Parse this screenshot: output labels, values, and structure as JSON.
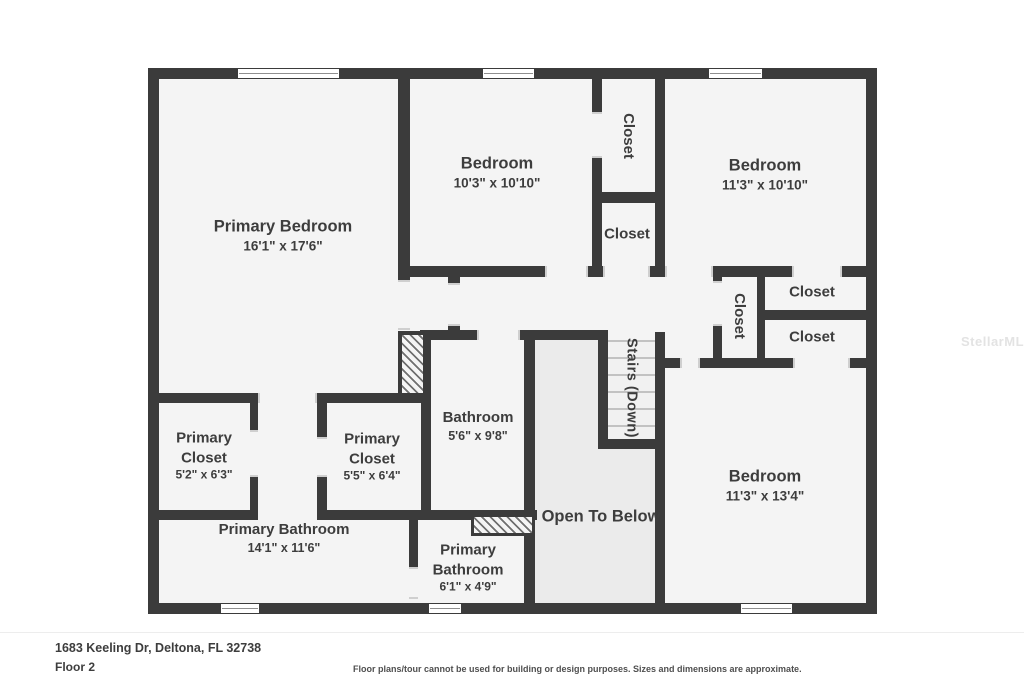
{
  "watermark": "StellarMLS",
  "footer": {
    "address": "1683 Keeling Dr, Deltona, FL 32738",
    "floor": "Floor 2",
    "disclaimer": "Floor plans/tour cannot be used for building or design purposes. Sizes and dimensions are approximate."
  },
  "rooms": {
    "primary_bedroom": {
      "name": "Primary Bedroom",
      "dims": "16'1\" x 17'6\""
    },
    "bedroom_top_middle": {
      "name": "Bedroom",
      "dims": "10'3\" x 10'10\""
    },
    "bedroom_top_right": {
      "name": "Bedroom",
      "dims": "11'3\" x 10'10\""
    },
    "bedroom_bottom_right": {
      "name": "Bedroom",
      "dims": "11'3\" x 13'4\""
    },
    "bathroom": {
      "name": "Bathroom",
      "dims": "5'6\" x 9'8\""
    },
    "primary_bathroom_large": {
      "name": "Primary Bathroom",
      "dims": "14'1\" x 11'6\""
    },
    "primary_bathroom_small": {
      "line1": "Primary",
      "line2": "Bathroom",
      "dims": "6'1\" x 4'9\""
    },
    "primary_closet_left": {
      "line1": "Primary",
      "line2": "Closet",
      "dims": "5'2\" x 6'3\""
    },
    "primary_closet_right": {
      "line1": "Primary",
      "line2": "Closet",
      "dims": "5'5\" x 6'4\""
    },
    "closet_tall": {
      "label": "Closet"
    },
    "closet_mid": {
      "label": "Closet"
    },
    "closet_hall": {
      "label": "Closet"
    },
    "closet_right_a": {
      "label": "Closet"
    },
    "closet_right_b": {
      "label": "Closet"
    },
    "stairs": {
      "label": "Stairs (Down)"
    },
    "open_to_below": {
      "label": "Open To Below"
    }
  },
  "colors": {
    "wall": "#3b3b3b",
    "room_fill": "#f4f4f4",
    "open_to_below_fill": "#ebebeb",
    "text": "#3d3d3d",
    "watermark": "#e3e3e3"
  }
}
